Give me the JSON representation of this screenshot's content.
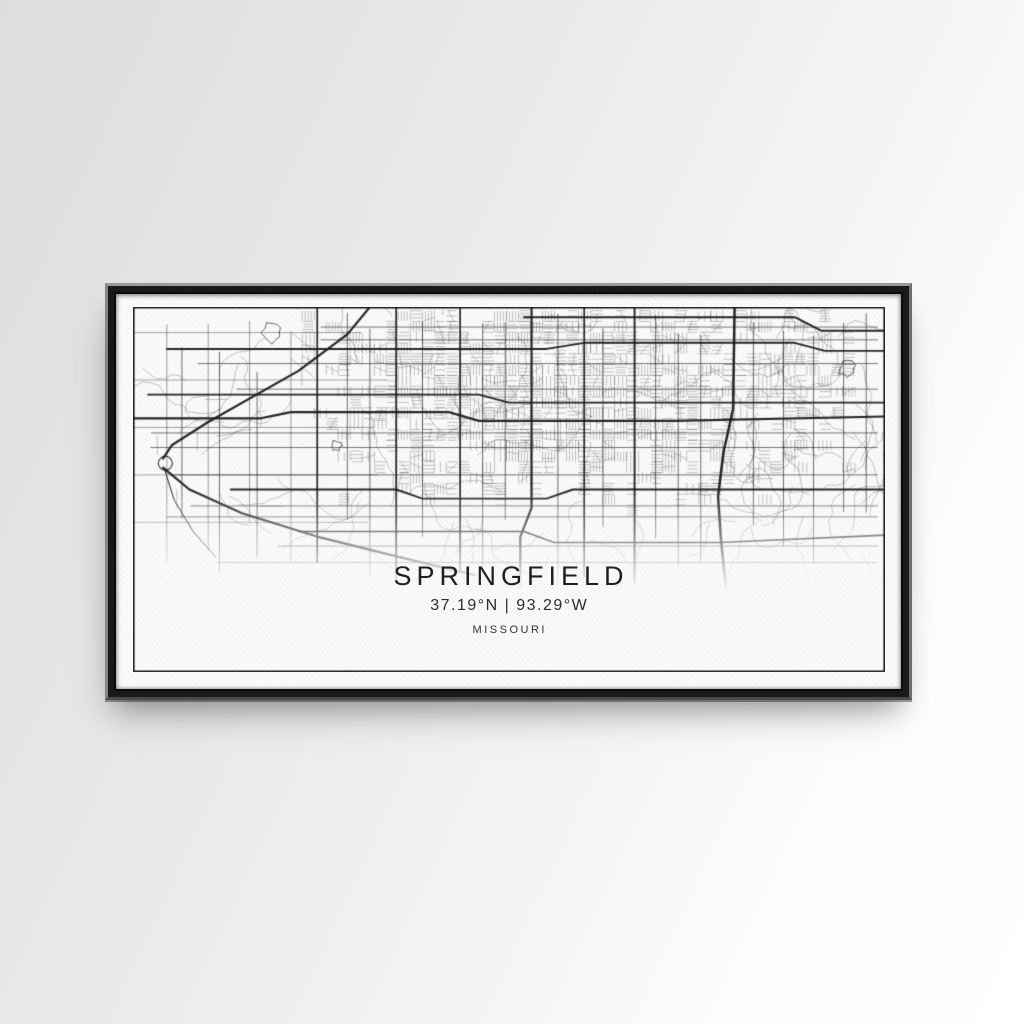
{
  "wall": {
    "color_top_left": "#dddddd",
    "color_bottom_right": "#ffffff"
  },
  "frame": {
    "style": "black-floating-frame",
    "color": "#19191b"
  },
  "artwork": {
    "title": "SPRINGFIELD",
    "coordinates": "37.19°N | 93.29°W",
    "region": "MISSOURI",
    "map_color": "#1a1a1a",
    "canvas_color": "#fbfbfa",
    "border_color": "#1d1d1d"
  }
}
